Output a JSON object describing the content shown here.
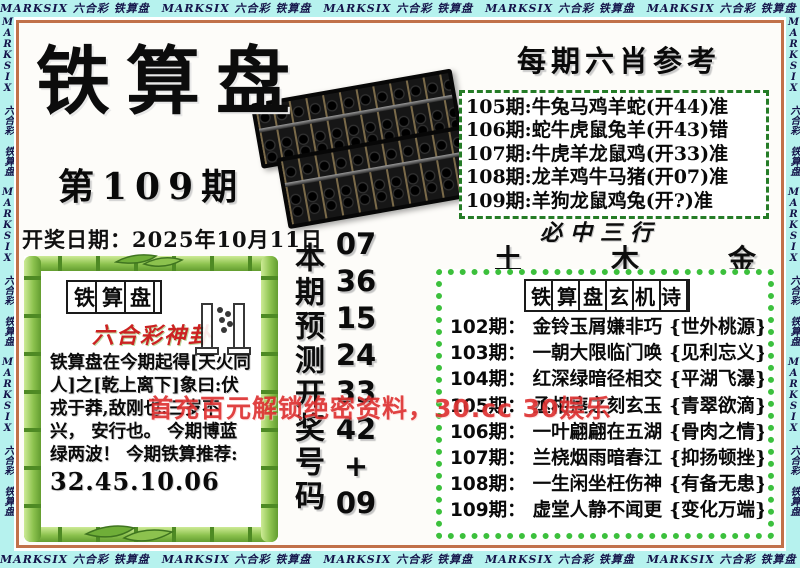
{
  "band": {
    "pattern": "MARKSIX 六合彩 铁算盘",
    "horizontal_text": "MARKSIX 六合彩 铁算盘　MARKSIX 六合彩 铁算盘　MARKSIX 六合彩 铁算盘　MARKSIX 六合彩 铁算盘　MARKSIX 六合彩 铁算盘",
    "vertical_text": "MARKSIX 六合彩 铁算盘 MARKSIX 六合彩 铁算盘 MARKSIX 六合彩 铁算盘",
    "color": "#b6f2ee"
  },
  "header": {
    "main_title": "铁算盘",
    "issue_label": "第109期",
    "draw_date": "开奖日期：2025年10月11日"
  },
  "six_zodiac_reference": {
    "title": "每期六肖参考",
    "rows": [
      {
        "period": "105期:",
        "animals": "牛兔马鸡羊蛇",
        "open": "(开44)",
        "verdict": "准"
      },
      {
        "period": "106期:",
        "animals": "蛇牛虎鼠兔羊",
        "open": "(开43)",
        "verdict": "错"
      },
      {
        "period": "107期:",
        "animals": "牛虎羊龙鼠鸡",
        "open": "(开33)",
        "verdict": "准"
      },
      {
        "period": "108期:",
        "animals": "龙羊鸡牛马猪",
        "open": "(开07)",
        "verdict": "准"
      },
      {
        "period": "109期:",
        "animals": "羊狗龙鼠鸡兔",
        "open": "(开?)",
        "verdict": "准"
      }
    ]
  },
  "three_elements": {
    "title": "必中三行",
    "values": [
      "土",
      "木",
      "金"
    ]
  },
  "mystery_poem": {
    "title": "铁算盘玄机诗",
    "rows": [
      {
        "period": "102期：",
        "verse": "金铃玉屑嫌非巧",
        "note": "{世外桃源}"
      },
      {
        "period": "103期：",
        "verse": "一朝大限临门唤",
        "note": "{见利忘义}"
      },
      {
        "period": "104期：",
        "verse": "红深绿暗径相交",
        "note": "{平湖飞瀑}"
      },
      {
        "period": "105期：",
        "verse": "丞相瘗之刻玄玉",
        "note": "{青翠欲滴}"
      },
      {
        "period": "106期：",
        "verse": "一叶翩翩在五湖",
        "note": "{骨肉之情}"
      },
      {
        "period": "107期：",
        "verse": "兰桡烟雨暗春江",
        "note": "{抑扬顿挫}"
      },
      {
        "period": "108期：",
        "verse": "一生闲坐枉伤神",
        "note": "{有备无患}"
      },
      {
        "period": "109期：",
        "verse": "虚堂人静不闻更",
        "note": "{变化万端}"
      }
    ]
  },
  "prediction": {
    "label": "本期预测开奖号码",
    "numbers": [
      "07",
      "36",
      "15",
      "24",
      "33",
      "42",
      "+",
      "09"
    ]
  },
  "hexagram_box": {
    "tag": "铁算盘",
    "subtitle": "六合彩神卦",
    "text": "铁算盘在今期起得[天火同人]之[乾上离下]象曰:伏戎于莽,敌刚也.三岁不兴， 安行也。 今期博蓝绿两波！ 今期铁算推荐:",
    "recommendation": "32.45.10.06"
  },
  "watermark": {
    "text": "首充百元解锁绝密资料，30.cc 30娱乐",
    "color": "#db2525"
  },
  "colors": {
    "band_background": "#b6f2ee",
    "frame_border": "#c1714a",
    "bamboo_green": "#8cc24e",
    "scallop_green": "#3cc03c",
    "dash_green": "#257c27",
    "accent_red": "#cc2222"
  }
}
